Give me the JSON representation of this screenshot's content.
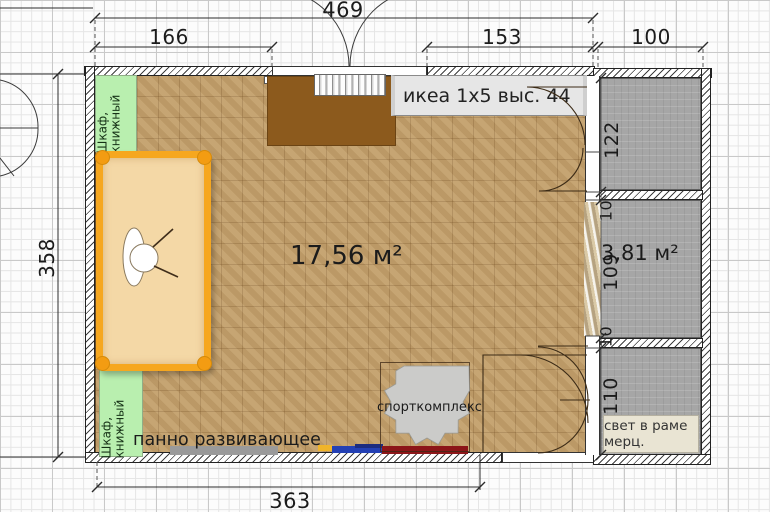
{
  "plan_labels": {
    "area_main": "17,56 м²",
    "area_right": "3,81 м²",
    "dim_469": "469",
    "dim_166": "166",
    "dim_153": "153",
    "dim_100": "100",
    "dim_358": "358",
    "dim_363": "363",
    "dim_122": "122",
    "dim_10a": "10",
    "dim_109": "109",
    "dim_10b": "10",
    "dim_110": "110",
    "bookcase_top": "Шкаф, книжный",
    "bookcase_bottom": "Шкаф, книжный",
    "ikea_shelf": "икеа 1x5 выс. 44",
    "panel": "панно развивающее",
    "sport_complex": "спорткомплекс",
    "light_frame": "свет в раме мерц."
  },
  "colors": {
    "floor": "#c3a06c",
    "desk": "#8c5a1d",
    "bed_frame": "#f6a71f",
    "mattress": "#f4d8a6",
    "bookcase_green": "#b9efaf",
    "room_gray": "#a6a6a6",
    "light_box": "#e9e4d3",
    "panel_gray": "#9a9a9a",
    "bar_yellow": "#f0b429",
    "bar_blue": "#2340b4",
    "bar_navy": "#1c2c80",
    "bar_red": "#8c1518"
  }
}
